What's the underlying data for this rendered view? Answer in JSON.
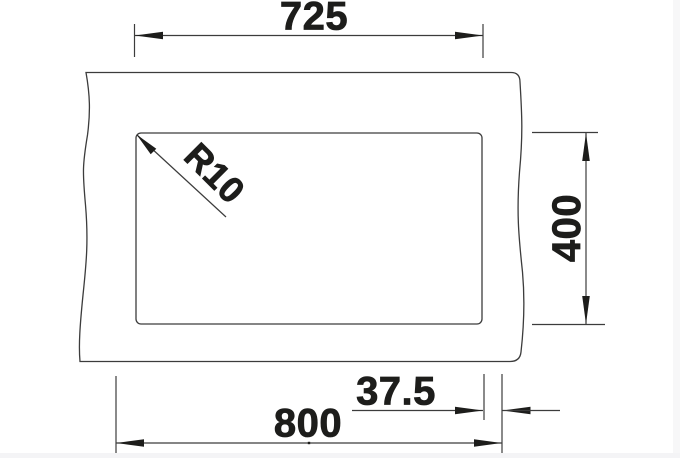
{
  "drawing": {
    "type": "technical-dimension-drawing",
    "subject": "undermount sink cutout plan view",
    "dimensions": {
      "top_width": "725",
      "side_height": "400",
      "edge_offset": "37.5",
      "bottom_width": "800",
      "corner_radius": "R10"
    },
    "colors": {
      "line": "#3c3c3c",
      "text": "#1d1d1b",
      "background": "#ffffff",
      "edge_strip": "#f5f5f7"
    }
  }
}
